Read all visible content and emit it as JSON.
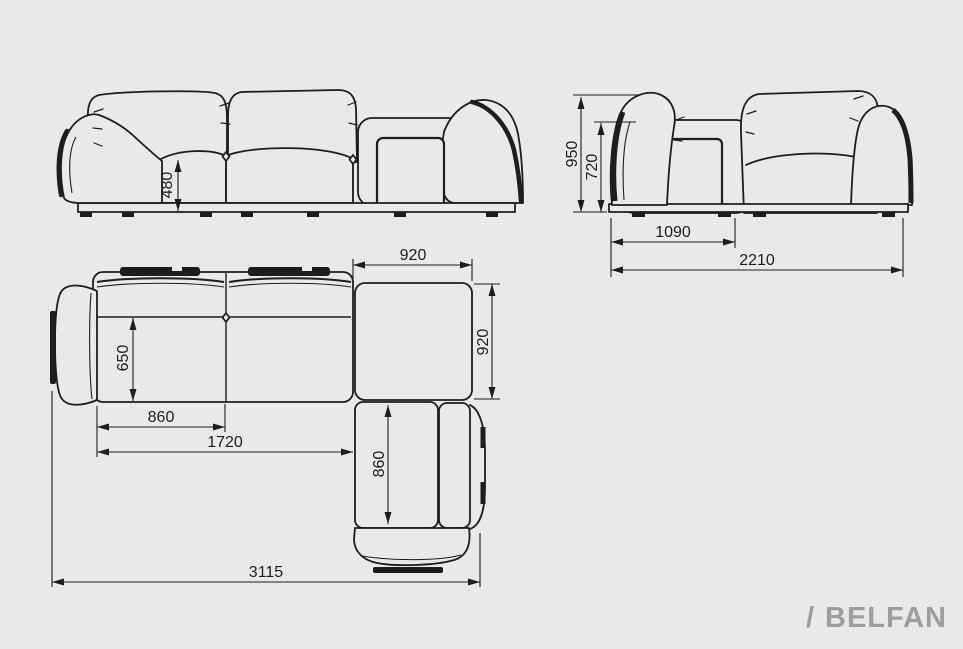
{
  "canvas": {
    "bg": "#e9e9e7",
    "ink": "#1d1d1b"
  },
  "views": {
    "front": {
      "title": "front-elevation",
      "seat_height": "480"
    },
    "side": {
      "title": "side-elevation",
      "overall_height": "950",
      "armrest_height": "720",
      "corner_module_depth": "1090",
      "overall_depth": "2210"
    },
    "plan": {
      "title": "top-plan",
      "corner_width": "920",
      "corner_depth": "920",
      "seat_depth": "650",
      "seat_width": "860",
      "two_seat_width": "1720",
      "chaise_seat_length": "860",
      "overall_length": "3115"
    }
  },
  "brand": {
    "mark": "/",
    "name": "BELFAN",
    "color": "#9d9d9d"
  }
}
